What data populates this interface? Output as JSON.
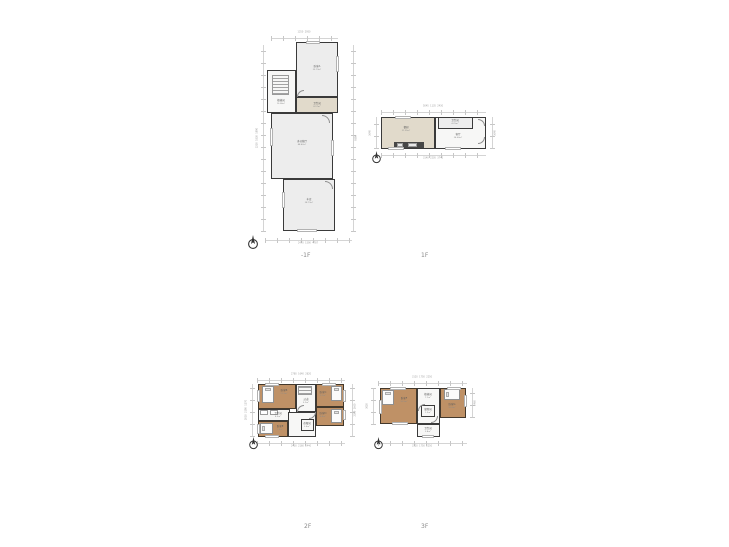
{
  "page": {
    "background": "#ffffff"
  },
  "colors": {
    "wall": "#3a3a3a",
    "room_gray": "#ededed",
    "room_tan": "#bf9166",
    "room_beige": "#e1dacb",
    "room_white": "#f7f7f6",
    "dim_line": "#c6c6c6",
    "room_label_text": "#5c5c5c",
    "floor_label_text": "#8a8a8a"
  },
  "floors": {
    "b1": {
      "label": "-1F",
      "rooms": {
        "bedroomA": {
          "name": "卧室A",
          "area": "25.73m²"
        },
        "stairwell": {
          "name": "楼梯间",
          "area": "10.06m²"
        },
        "bath": {
          "name": "卫生间",
          "area": "8.97m²"
        },
        "multi": {
          "name": "多功能厅",
          "area": "48.42m²"
        },
        "garage": {
          "name": "车库",
          "area": "28.73m²"
        }
      },
      "dims": {
        "top": "1250  2950",
        "bottom": "2470  1590  4787",
        "left": "2230  5330  1890",
        "right": "9590"
      }
    },
    "f1": {
      "label": "1F",
      "rooms": {
        "kitchen": {
          "name": "餐厨",
          "area": "21.35m²"
        },
        "living": {
          "name": "客厅",
          "area": "24.60m²"
        },
        "bath": {
          "name": "卫生间",
          "area": "4.25m²"
        }
      },
      "dims": {
        "top": "5045  1135  2430",
        "bottom": "3140  2205  3740",
        "left": "3640",
        "right": "3640"
      }
    },
    "f2": {
      "label": "2F",
      "rooms": {
        "bedroomB": {
          "name": "卧室B",
          "area": "11.2m²"
        },
        "hall": {
          "name": "过道",
          "area": "5.9m²"
        },
        "bedroomC": {
          "name": "卧室C",
          "area": "9.7m²"
        },
        "bedroomD": {
          "name": "卧室D",
          "area": "8.8m²"
        },
        "bath": {
          "name": "卫生间",
          "area": "4.3m²"
        },
        "bedroomE": {
          "name": "卧室E",
          "area": "7.6m²"
        },
        "closet": {
          "name": "衣帽间",
          "area": "2.4m²"
        }
      },
      "dims": {
        "top": "2780  1640  2620",
        "bottom": "2430  2160  2440",
        "left": "2010  2190  1270",
        "right": "2300  1660"
      }
    },
    "f3": {
      "label": "3F",
      "rooms": {
        "bedroomF": {
          "name": "卧室F",
          "area": "16.5m²"
        },
        "hall": {
          "name": "楼梯间",
          "area": "7.1m²"
        },
        "bedroomG": {
          "name": "卧室G",
          "area": "10.6m²"
        },
        "closet": {
          "name": "储物间",
          "area": "1.9m²"
        },
        "bath": {
          "name": "卫生间",
          "area": "3.8m²"
        }
      },
      "dims": {
        "top": "3120  1750  2250",
        "bottom": "3120  1750  2250",
        "left": "3020",
        "right": "2460"
      }
    }
  }
}
